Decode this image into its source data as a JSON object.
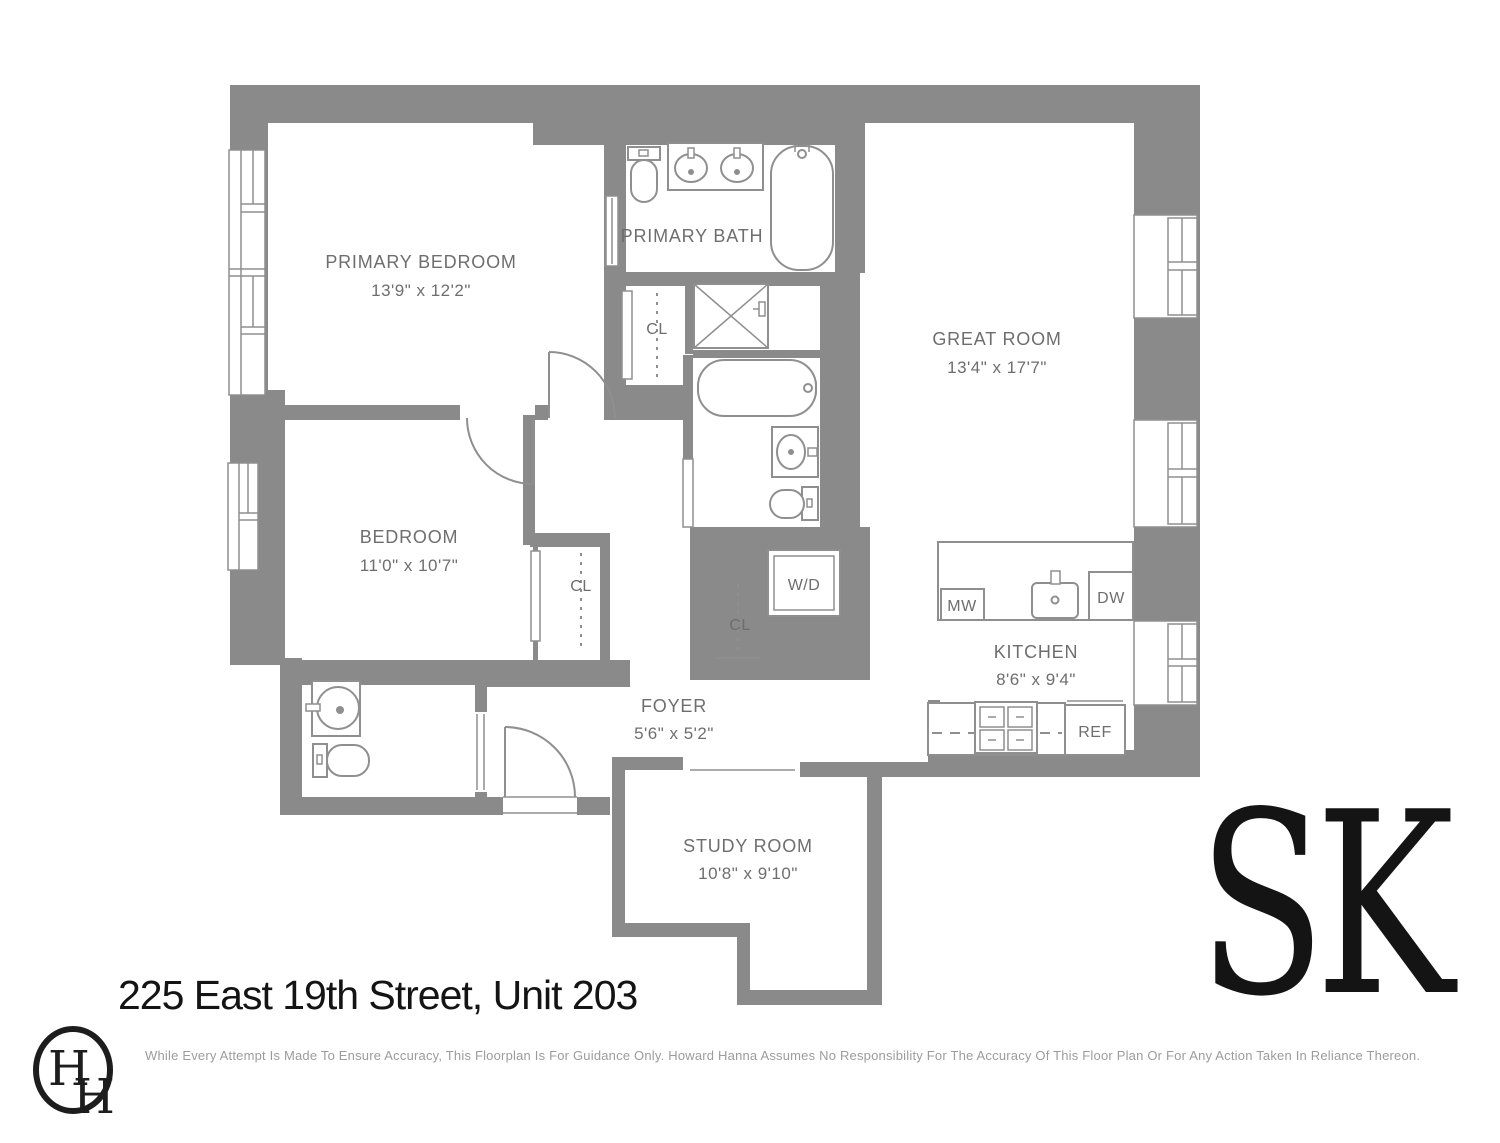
{
  "header": {
    "title": "225 East 19th Street, Unit 203"
  },
  "footer": {
    "disclaimer": "While Every Attempt Is Made To Ensure Accuracy, This Floorplan Is For Guidance Only. Howard Hanna Assumes No Responsibility For The Accuracy Of This Floor Plan Or For Any Action Taken In Reliance Thereon."
  },
  "branding": {
    "sk_logo": "SK",
    "hh_monogram_left": "H",
    "hh_monogram_right": "H"
  },
  "rooms": [
    {
      "name": "PRIMARY BEDROOM",
      "dims": "13'9\" x 12'2\""
    },
    {
      "name": "PRIMARY BATH",
      "dims": ""
    },
    {
      "name": "GREAT ROOM",
      "dims": "13'4\" x 17'7\""
    },
    {
      "name": "BEDROOM",
      "dims": "11'0\" x 10'7\""
    },
    {
      "name": "KITCHEN",
      "dims": "8'6\" x 9'4\""
    },
    {
      "name": "FOYER",
      "dims": "5'6\" x 5'2\""
    },
    {
      "name": "STUDY ROOM",
      "dims": "10'8\" x 9'10\""
    }
  ],
  "labels": {
    "closet": "CL",
    "washer_dryer": "W/D",
    "microwave": "MW",
    "dishwasher": "DW",
    "refrigerator": "REF"
  },
  "colors": {
    "wall": "#8a8a8a",
    "fixture_line": "#8f8f8f",
    "room_label": "#6e6e6e",
    "title": "#141414",
    "disclaimer": "#9c9c9c",
    "logo": "#141414"
  }
}
